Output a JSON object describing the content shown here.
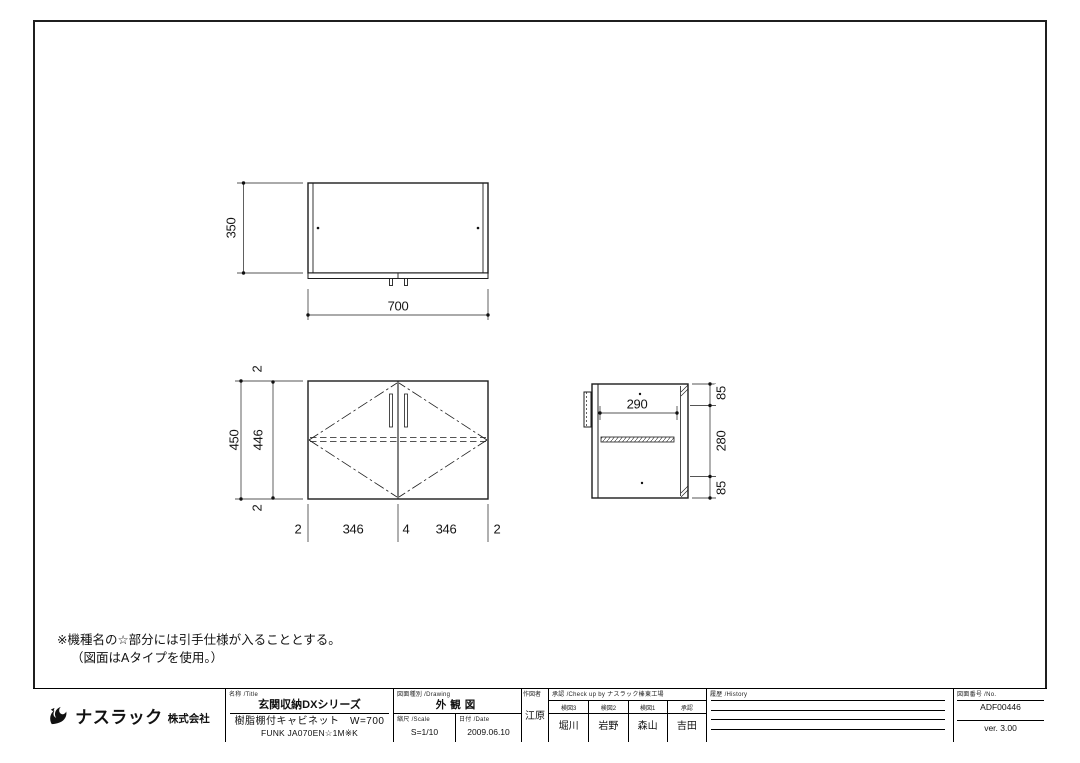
{
  "note": {
    "line1": "※機種名の☆部分には引手仕様が入ることとする。",
    "line2": "（図面はAタイプを使用。）"
  },
  "dims": {
    "top_height": "350",
    "top_width": "700",
    "front_gap_top": "2",
    "front_overall": "450",
    "front_inner": "446",
    "front_gap_bottom": "2",
    "front_b1": "2",
    "front_b2": "346",
    "front_b3": "4",
    "front_b4": "346",
    "front_b5": "2",
    "side_depth": "290",
    "side_top": "85",
    "side_mid": "280",
    "side_bottom": "85"
  },
  "title_block": {
    "company": {
      "name": "ナスラック",
      "suffix": "株式会社"
    },
    "title": {
      "header": "名称 /Title",
      "series": "玄関収納DXシリーズ",
      "product": "樹脂棚付キャビネット　W=700",
      "model": "FUNK JA070EN☆1M※K"
    },
    "drawing": {
      "header": "図面種別 /Drawing",
      "type": "外観図",
      "scale_header": "縮尺 /Scale",
      "scale": "S=1/10",
      "date_header": "日付 /Date",
      "date": "2009.06.10"
    },
    "drafter": {
      "header": "作図者",
      "name": "江原"
    },
    "check": {
      "header": "承認 /Check up by ナスラック榛東工場",
      "cols": [
        {
          "role": "検図3",
          "name": "堀川"
        },
        {
          "role": "検図2",
          "name": "岩野"
        },
        {
          "role": "検図1",
          "name": "森山"
        },
        {
          "role": "承認",
          "name": "吉田"
        }
      ]
    },
    "history": {
      "header": "履歴 /History"
    },
    "number": {
      "header": "図面番号 /No.",
      "no": "ADF00446",
      "version": "ver. 3.00"
    }
  }
}
